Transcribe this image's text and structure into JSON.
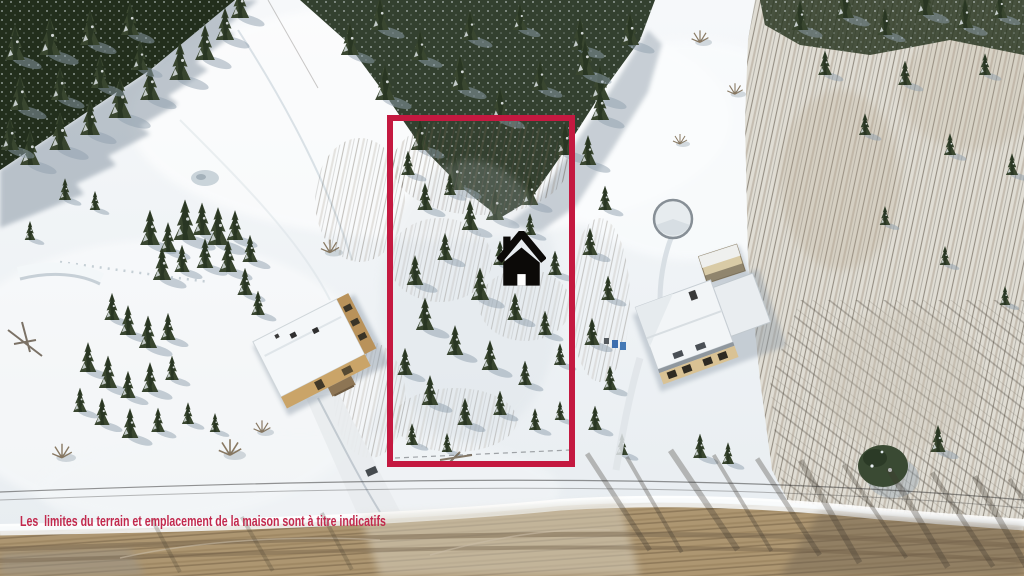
{
  "image": {
    "type": "aerial-drone-photo",
    "season": "winter"
  },
  "annotations": {
    "disclaimer_text": "Les  limites du terrain et emplacement de la maison sont à titre indicatifs",
    "disclaimer_color": "#c2294d",
    "lot_boundary_color": "#c41940",
    "marker_icon": "home-icon",
    "marker_color": "#0c0a08"
  },
  "scene": {
    "palette": {
      "snow": "#eef2f5",
      "snow_shadow": "#aebcc6",
      "evergreen": "#33412c",
      "bare_forest": "#d9d3c8",
      "road": "#ab9370",
      "house_roof": "#f4f7f9",
      "house_wall": "#c29a5e"
    },
    "labels": {
      "marked_lot": "wooded lot outlined in red",
      "west_house": "neighbor house with tan walls",
      "east_house": "neighbor house with snowy roof",
      "pool": "snow-covered round pool",
      "road": "gravel road with snowbanks"
    }
  }
}
